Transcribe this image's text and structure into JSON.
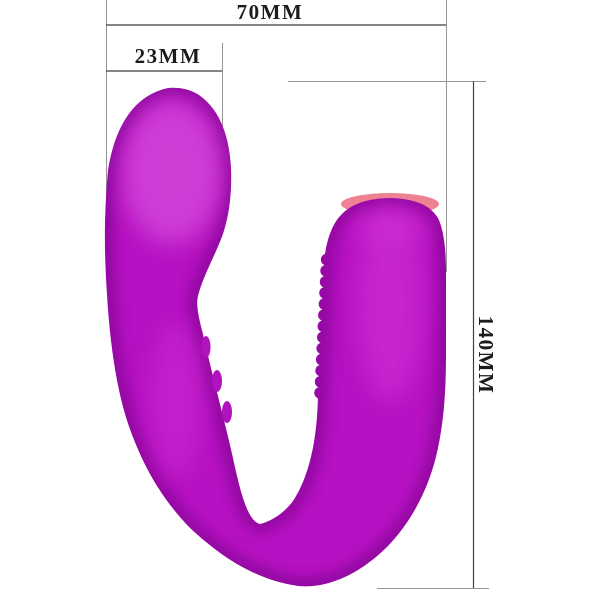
{
  "diagram": {
    "type": "product-dimension-diagram",
    "dimensions": {
      "total_width_label": "70MM",
      "head_width_label": "23MM",
      "total_height_label": "140MM"
    },
    "colors": {
      "background": "#ffffff",
      "body": "#b611c2",
      "body_shadow": "#6f0680",
      "body_highlight": "#e66cec",
      "rim": "#ef8292",
      "ridge": "#b013bd",
      "dim_line": "#3f3f3f",
      "ext_line": "#949494",
      "label_text": "#1c1c1c"
    }
  }
}
